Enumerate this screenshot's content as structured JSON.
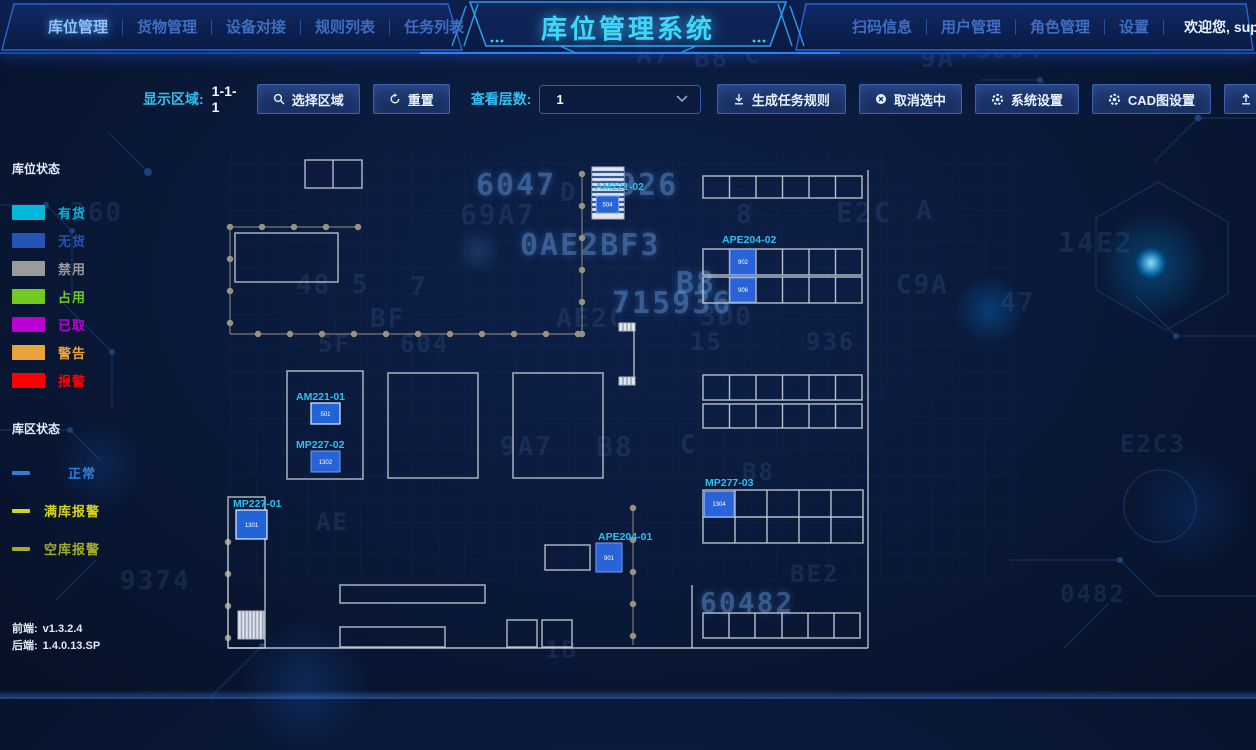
{
  "header": {
    "title": "库位管理系统",
    "left_nav": [
      {
        "label": "库位管理",
        "active": true
      },
      {
        "label": "货物管理",
        "active": false
      },
      {
        "label": "设备对接",
        "active": false
      },
      {
        "label": "规则列表",
        "active": false
      },
      {
        "label": "任务列表",
        "active": false
      }
    ],
    "right_nav": [
      {
        "label": "扫码信息"
      },
      {
        "label": "用户管理"
      },
      {
        "label": "角色管理"
      },
      {
        "label": "设置"
      }
    ],
    "welcome": "欢迎您, super",
    "accent_color": "#3fd6f8"
  },
  "toolbar": {
    "display_area_label": "显示区域:",
    "display_area_value": "1-1-1",
    "select_region_label": "选择区域",
    "reset_label": "重置",
    "layer_label": "查看层数:",
    "layer_value": "1",
    "generate_rule_label": "生成任务规则",
    "cancel_selection_label": "取消选中",
    "system_settings_label": "系统设置",
    "cad_settings_label": "CAD图设置",
    "upload_label": "上传文件"
  },
  "legend": {
    "slot_title": "库位状态",
    "slot_items": [
      {
        "label": "有货",
        "color": "#00b8d9"
      },
      {
        "label": "无货",
        "color": "#2454b5"
      },
      {
        "label": "禁用",
        "color": "#9b9b9b"
      },
      {
        "label": "占用",
        "color": "#6fcb23"
      },
      {
        "label": "已取",
        "color": "#bb00d6"
      },
      {
        "label": "警告",
        "color": "#e8a33d"
      },
      {
        "label": "报警",
        "color": "#fe0000"
      }
    ],
    "area_title": "库区状态",
    "area_items": [
      {
        "label": "正常",
        "color": "#2d7fd9"
      },
      {
        "label": "满库报警",
        "color": "#d4d41c"
      },
      {
        "label": "空库报警",
        "color": "#a5ad25"
      }
    ]
  },
  "versions": {
    "frontend_label": "前端:",
    "frontend_value": "v1.3.2.4",
    "backend_label": "后端:",
    "backend_value": "1.4.0.13.SP"
  },
  "floorplan": {
    "labels": {
      "am221_02": "AM221-02",
      "ape204_02": "APE204-02",
      "am221_01": "AM221-01",
      "mp227_02": "MP227-02",
      "mp227_01": "MP227-01",
      "ape204_01": "APE204-01",
      "mp277_03": "MP277-03"
    },
    "cells": {
      "c504": "504",
      "c902": "902",
      "c906": "906",
      "c501": "501",
      "c1302": "1302",
      "c1301": "1301",
      "c901": "901",
      "c1304": "1304"
    }
  },
  "backdrop": {
    "glyphs": [
      {
        "t": "A7",
        "x": 636,
        "y": 40,
        "s": 26
      },
      {
        "t": "B8",
        "x": 694,
        "y": 44,
        "s": 26
      },
      {
        "t": "C",
        "x": 744,
        "y": 40,
        "s": 26
      },
      {
        "t": "9A",
        "x": 920,
        "y": 44,
        "s": 26
      },
      {
        "t": "F3D04",
        "x": 960,
        "y": 36,
        "s": 24
      },
      {
        "t": "6047",
        "x": 476,
        "y": 168,
        "s": 30,
        "b": 1
      },
      {
        "t": "5926",
        "x": 598,
        "y": 168,
        "s": 30,
        "b": 1
      },
      {
        "t": "D",
        "x": 560,
        "y": 178,
        "s": 26
      },
      {
        "t": "69A7",
        "x": 460,
        "y": 198,
        "s": 28
      },
      {
        "t": "8",
        "x": 736,
        "y": 200,
        "s": 26
      },
      {
        "t": "E2C",
        "x": 836,
        "y": 196,
        "s": 28
      },
      {
        "t": "A",
        "x": 916,
        "y": 196,
        "s": 26
      },
      {
        "t": "260",
        "x": 70,
        "y": 198,
        "s": 26
      },
      {
        "t": "0AE2BF3",
        "x": 520,
        "y": 228,
        "s": 30,
        "b": 1
      },
      {
        "t": "14E2",
        "x": 1058,
        "y": 226,
        "s": 28
      },
      {
        "t": "48",
        "x": 296,
        "y": 270,
        "s": 26
      },
      {
        "t": "5",
        "x": 352,
        "y": 270,
        "s": 26
      },
      {
        "t": "7",
        "x": 410,
        "y": 272,
        "s": 26
      },
      {
        "t": "B8",
        "x": 676,
        "y": 266,
        "s": 30,
        "b": 1
      },
      {
        "t": "C9A",
        "x": 896,
        "y": 270,
        "s": 26
      },
      {
        "t": "715936",
        "x": 612,
        "y": 286,
        "s": 30,
        "b": 1
      },
      {
        "t": "47",
        "x": 1000,
        "y": 288,
        "s": 26
      },
      {
        "t": "BF",
        "x": 370,
        "y": 304,
        "s": 26
      },
      {
        "t": "AE2C",
        "x": 556,
        "y": 304,
        "s": 26
      },
      {
        "t": "3D0",
        "x": 700,
        "y": 302,
        "s": 26
      },
      {
        "t": "5F",
        "x": 318,
        "y": 330,
        "s": 24
      },
      {
        "t": "604",
        "x": 400,
        "y": 330,
        "s": 24
      },
      {
        "t": "15",
        "x": 690,
        "y": 328,
        "s": 24
      },
      {
        "t": "936",
        "x": 806,
        "y": 328,
        "s": 24
      },
      {
        "t": "9A7",
        "x": 500,
        "y": 432,
        "s": 26
      },
      {
        "t": "B8",
        "x": 596,
        "y": 430,
        "s": 28
      },
      {
        "t": "C",
        "x": 680,
        "y": 430,
        "s": 26
      },
      {
        "t": "E2C3",
        "x": 1120,
        "y": 430,
        "s": 24
      },
      {
        "t": "B8",
        "x": 742,
        "y": 458,
        "s": 24
      },
      {
        "t": "BE2",
        "x": 790,
        "y": 560,
        "s": 24
      },
      {
        "t": "AE",
        "x": 316,
        "y": 508,
        "s": 24
      },
      {
        "t": "9374",
        "x": 120,
        "y": 566,
        "s": 26
      },
      {
        "t": "60482",
        "x": 700,
        "y": 586,
        "s": 28,
        "b": 1
      },
      {
        "t": "0482",
        "x": 1060,
        "y": 580,
        "s": 24
      },
      {
        "t": "1B",
        "x": 545,
        "y": 636,
        "s": 24
      }
    ]
  }
}
